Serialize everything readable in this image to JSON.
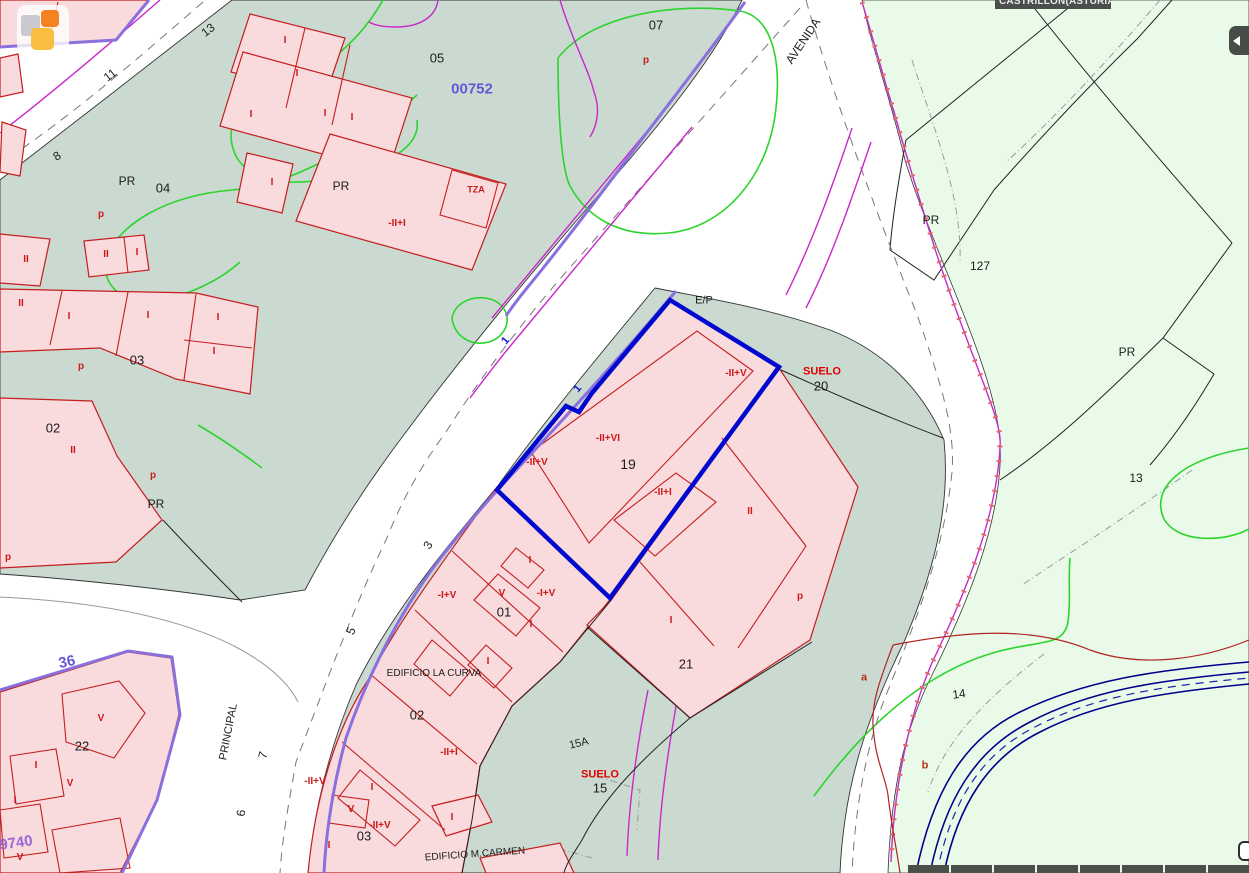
{
  "header": {
    "region_label": "CASTRILLON(ASTURIAS)"
  },
  "controls": {
    "scale_bar_segments": 8
  },
  "colors": {
    "urban_zone": "#cbdad1",
    "rustic_zone": "#e9fae9",
    "parcel_fill": "#f9dadd",
    "parcel_outline": "#c41e1e",
    "selected_parcel": "#0009cd",
    "road_edge_violet": "#8a70dd",
    "utility_magenta": "#ca28ca",
    "contour_green": "#2cd42c",
    "stream_navy": "#00008b",
    "ui_bar": "#4b4f4b"
  },
  "map": {
    "labels": [
      {
        "t": "05",
        "x": 437,
        "y": 58
      },
      {
        "t": "07",
        "x": 656,
        "y": 25
      },
      {
        "t": "04",
        "x": 163,
        "y": 188
      },
      {
        "t": "PR",
        "x": 127,
        "y": 181,
        "s": 12
      },
      {
        "t": "PR",
        "x": 341,
        "y": 186,
        "s": 12
      },
      {
        "t": "03",
        "x": 137,
        "y": 360
      },
      {
        "t": "02",
        "x": 53,
        "y": 428
      },
      {
        "t": "PR",
        "x": 156,
        "y": 504,
        "s": 12
      },
      {
        "t": "E/P",
        "x": 704,
        "y": 301,
        "s": 11
      },
      {
        "t": "19",
        "x": 628,
        "y": 464,
        "s": 14
      },
      {
        "t": "20",
        "x": 821,
        "y": 386
      },
      {
        "t": "21",
        "x": 686,
        "y": 664
      },
      {
        "t": "01",
        "x": 504,
        "y": 612
      },
      {
        "t": "02",
        "x": 417,
        "y": 715
      },
      {
        "t": "03",
        "x": 364,
        "y": 836
      },
      {
        "t": "22",
        "x": 82,
        "y": 746
      },
      {
        "t": "15",
        "x": 600,
        "y": 788
      },
      {
        "t": "15A",
        "x": 579,
        "y": 744,
        "s": 11,
        "r": -14
      },
      {
        "t": "PR",
        "x": 931,
        "y": 220,
        "s": 12
      },
      {
        "t": "127",
        "x": 980,
        "y": 266,
        "s": 12
      },
      {
        "t": "PR",
        "x": 1127,
        "y": 352,
        "s": 12
      },
      {
        "t": "13",
        "x": 1136,
        "y": 478,
        "s": 12
      },
      {
        "t": "14",
        "x": 959,
        "y": 694,
        "s": 12,
        "r": -8
      },
      {
        "t": "EDIFICIO LA CURVA",
        "x": 434,
        "y": 674,
        "s": 10
      },
      {
        "t": "EDIFICIO M.CARMEN",
        "x": 475,
        "y": 855,
        "s": 10,
        "r": -4
      },
      {
        "t": "AVENIDA",
        "x": 803,
        "y": 41,
        "s": 12,
        "r": -56
      },
      {
        "t": "PRINCIPAL",
        "x": 229,
        "y": 732,
        "s": 11,
        "r": -79
      },
      {
        "t": "13",
        "x": 208,
        "y": 30,
        "s": 12,
        "r": -38
      },
      {
        "t": "11",
        "x": 110,
        "y": 75,
        "s": 12,
        "r": -38
      },
      {
        "t": "8",
        "x": 57,
        "y": 156,
        "s": 12,
        "r": -33
      },
      {
        "t": "3",
        "x": 428,
        "y": 545,
        "s": 12,
        "r": -58
      },
      {
        "t": "5",
        "x": 351,
        "y": 631,
        "s": 12,
        "r": -66
      },
      {
        "t": "7",
        "x": 263,
        "y": 755,
        "s": 12,
        "r": -74
      },
      {
        "t": "6",
        "x": 241,
        "y": 813,
        "s": 12,
        "r": -84
      },
      {
        "t": "00752",
        "x": 472,
        "y": 89,
        "k": "blue"
      },
      {
        "t": "36",
        "x": 67,
        "y": 662,
        "k": "blue",
        "r": -12
      },
      {
        "t": "9740",
        "x": 16,
        "y": 843,
        "k": "purple",
        "r": -8
      },
      {
        "t": "1",
        "x": 506,
        "y": 341,
        "k": "blueid",
        "r": -50
      },
      {
        "t": "1",
        "x": 578,
        "y": 389,
        "k": "blueid",
        "r": -50
      },
      {
        "t": "SUELO",
        "x": 822,
        "y": 372,
        "k": "suelo"
      },
      {
        "t": "SUELO",
        "x": 600,
        "y": 775,
        "k": "suelo"
      },
      {
        "t": "a",
        "x": 864,
        "y": 678,
        "k": "brown"
      },
      {
        "t": "b",
        "x": 925,
        "y": 766,
        "k": "brown"
      },
      {
        "t": "I",
        "x": 285,
        "y": 41,
        "k": "red"
      },
      {
        "t": "I",
        "x": 297,
        "y": 74,
        "k": "red"
      },
      {
        "t": "I",
        "x": 251,
        "y": 115,
        "k": "red"
      },
      {
        "t": "I",
        "x": 325,
        "y": 114,
        "k": "red"
      },
      {
        "t": "I",
        "x": 352,
        "y": 118,
        "k": "red"
      },
      {
        "t": "p",
        "x": 646,
        "y": 61,
        "k": "red"
      },
      {
        "t": "p",
        "x": 101,
        "y": 215,
        "k": "red"
      },
      {
        "t": "I",
        "x": 272,
        "y": 183,
        "k": "red"
      },
      {
        "t": "TZA",
        "x": 476,
        "y": 190,
        "k": "red",
        "s": 9
      },
      {
        "t": "-II+I",
        "x": 397,
        "y": 224,
        "k": "red"
      },
      {
        "t": "II",
        "x": 106,
        "y": 255,
        "k": "red"
      },
      {
        "t": "I",
        "x": 137,
        "y": 253,
        "k": "red"
      },
      {
        "t": "II",
        "x": 26,
        "y": 260,
        "k": "red"
      },
      {
        "t": "II",
        "x": 21,
        "y": 304,
        "k": "red"
      },
      {
        "t": "I",
        "x": 69,
        "y": 317,
        "k": "red"
      },
      {
        "t": "I",
        "x": 148,
        "y": 316,
        "k": "red"
      },
      {
        "t": "I",
        "x": 218,
        "y": 318,
        "k": "red"
      },
      {
        "t": "I",
        "x": 214,
        "y": 352,
        "k": "red"
      },
      {
        "t": "p",
        "x": 81,
        "y": 367,
        "k": "red"
      },
      {
        "t": "II",
        "x": 73,
        "y": 451,
        "k": "red"
      },
      {
        "t": "p",
        "x": 153,
        "y": 476,
        "k": "red"
      },
      {
        "t": "p",
        "x": 8,
        "y": 558,
        "k": "red"
      },
      {
        "t": "-II+V",
        "x": 537,
        "y": 463,
        "k": "red"
      },
      {
        "t": "-II+VI",
        "x": 608,
        "y": 439,
        "k": "red"
      },
      {
        "t": "-II+I",
        "x": 663,
        "y": 493,
        "k": "red"
      },
      {
        "t": "-II+V",
        "x": 736,
        "y": 374,
        "k": "red"
      },
      {
        "t": "II",
        "x": 750,
        "y": 512,
        "k": "red"
      },
      {
        "t": "p",
        "x": 800,
        "y": 597,
        "k": "red"
      },
      {
        "t": "I",
        "x": 671,
        "y": 621,
        "k": "red"
      },
      {
        "t": "I",
        "x": 530,
        "y": 561,
        "k": "red"
      },
      {
        "t": "-I+V",
        "x": 447,
        "y": 596,
        "k": "red"
      },
      {
        "t": "V",
        "x": 502,
        "y": 594,
        "k": "red"
      },
      {
        "t": "-I+V",
        "x": 546,
        "y": 594,
        "k": "red"
      },
      {
        "t": "I",
        "x": 531,
        "y": 625,
        "k": "red"
      },
      {
        "t": "I",
        "x": 488,
        "y": 662,
        "k": "red"
      },
      {
        "t": "-II+I",
        "x": 449,
        "y": 753,
        "k": "red"
      },
      {
        "t": "-II+V",
        "x": 315,
        "y": 782,
        "k": "red"
      },
      {
        "t": "I",
        "x": 372,
        "y": 788,
        "k": "red"
      },
      {
        "t": "V",
        "x": 351,
        "y": 810,
        "k": "red"
      },
      {
        "t": "-II+V",
        "x": 380,
        "y": 826,
        "k": "red"
      },
      {
        "t": "I",
        "x": 329,
        "y": 846,
        "k": "red"
      },
      {
        "t": "I",
        "x": 452,
        "y": 818,
        "k": "red"
      },
      {
        "t": "V",
        "x": 101,
        "y": 719,
        "k": "red"
      },
      {
        "t": "I",
        "x": 36,
        "y": 766,
        "k": "red"
      },
      {
        "t": "V",
        "x": 70,
        "y": 784,
        "k": "red"
      },
      {
        "t": "I",
        "x": 15,
        "y": 801,
        "k": "red"
      },
      {
        "t": "V",
        "x": 20,
        "y": 858,
        "k": "red"
      }
    ]
  }
}
